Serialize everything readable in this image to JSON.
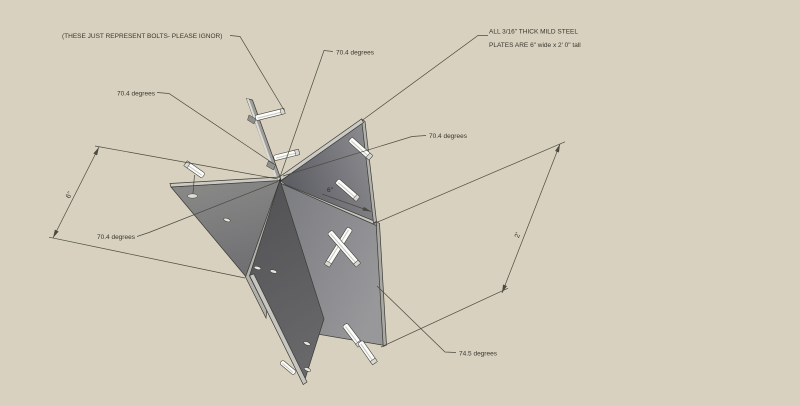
{
  "drawing": {
    "notes": {
      "bolts_note": "(THESE JUST REPRESENT BOLTS- PLEASE IGNOR)",
      "material_note_line1": "ALL 3/16\" THICK MILD STEEL",
      "material_note_line2": "PLATES ARE 6\" wide x 2' 0\" tall"
    },
    "angle_labels": {
      "top": "70.4 degrees",
      "left": "70.4 degrees",
      "right": "70.4 degrees",
      "bottom_left": "70.4 degrees",
      "bottom_right": "74.5 degrees"
    },
    "dimensions": {
      "plate_width_left": "6\"",
      "plate_width_inner": "6\"",
      "plate_height": "2'"
    },
    "colors": {
      "background": "#d8d1bf",
      "line": "#4b4a40",
      "text": "#38372e",
      "plate_edge_highlight": "#cbcac4",
      "plate_face_dark": "#515154",
      "plate_face_medium": "#7b7c80",
      "bolt": "#fcfcfa"
    }
  }
}
